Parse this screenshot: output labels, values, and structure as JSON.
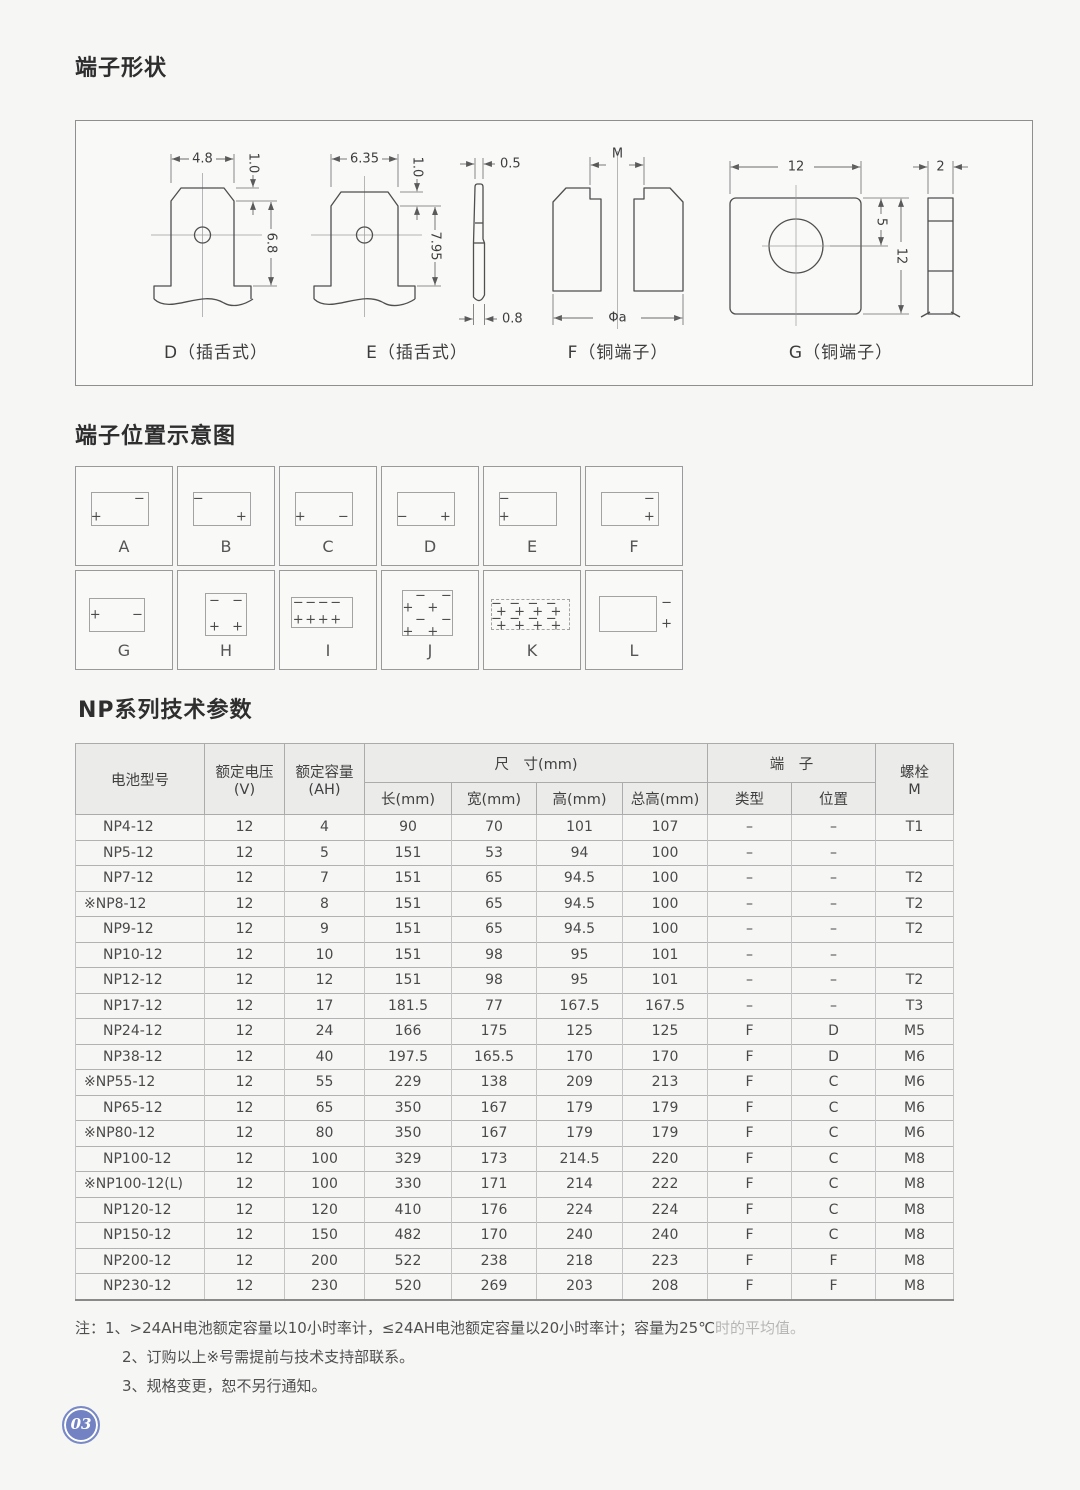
{
  "page": {
    "number": "03"
  },
  "shapes": {
    "title": "端子形状",
    "d_label": "D（插舌式）",
    "d_width": "4.8",
    "d_bevel": "1.0",
    "d_height": "6.8",
    "e_label": "E（插舌式）",
    "e_width": "6.35",
    "e_bevel": "1.0",
    "e_height": "7.95",
    "side_top": "0.5",
    "side_bottom": "0.8",
    "f_label": "F（铜端子）",
    "f_top": "M",
    "f_bottom": "Φa",
    "g_label": "G（铜端子）",
    "g_width": "12",
    "g_hole": "5",
    "g_height": "12",
    "g_thickness": "2"
  },
  "positions": {
    "title": "端子位置示意图",
    "cells": [
      {
        "label": "A",
        "box": [
          16,
          26,
          60,
          34
        ],
        "marks": [
          [
            "−",
            66,
            33
          ],
          [
            "+",
            21,
            51
          ]
        ]
      },
      {
        "label": "B",
        "box": [
          16,
          26,
          60,
          34
        ],
        "marks": [
          [
            "−",
            21,
            33
          ],
          [
            "+",
            66,
            51
          ]
        ]
      },
      {
        "label": "C",
        "box": [
          16,
          26,
          60,
          34
        ],
        "marks": [
          [
            "+",
            21,
            51
          ],
          [
            "−",
            66,
            51
          ]
        ]
      },
      {
        "label": "D",
        "box": [
          16,
          26,
          60,
          34
        ],
        "marks": [
          [
            "−",
            21,
            51
          ],
          [
            "+",
            66,
            51
          ]
        ]
      },
      {
        "label": "E",
        "box": [
          16,
          26,
          60,
          34
        ],
        "marks": [
          [
            "−",
            21,
            33
          ],
          [
            "+",
            21,
            51
          ]
        ]
      },
      {
        "label": "F",
        "box": [
          16,
          26,
          60,
          34
        ],
        "marks": [
          [
            "−",
            66,
            33
          ],
          [
            "+",
            66,
            51
          ]
        ]
      },
      {
        "label": "G",
        "box": [
          14,
          28,
          58,
          34
        ],
        "marks": [
          [
            "+",
            20,
            45
          ],
          [
            "−",
            64,
            45
          ]
        ]
      },
      {
        "label": "H",
        "box": [
          28,
          22,
          44,
          44
        ],
        "marks": [
          [
            "−",
            38,
            31
          ],
          [
            "−",
            62,
            31
          ],
          [
            "+",
            38,
            57
          ],
          [
            "+",
            62,
            57
          ]
        ]
      },
      {
        "label": "I",
        "box": [
          11,
          27,
          65,
          31
        ],
        "marks": [
          [
            "−",
            19,
            33
          ],
          [
            "−",
            32,
            33
          ],
          [
            "−",
            45,
            33
          ],
          [
            "−",
            58,
            33
          ],
          [
            "+",
            19,
            50
          ],
          [
            "+",
            32,
            50
          ],
          [
            "+",
            45,
            50
          ],
          [
            "+",
            58,
            50
          ]
        ]
      },
      {
        "label": "J",
        "box": [
          21,
          19,
          53,
          47
        ],
        "marks": [
          [
            "−",
            40,
            26
          ],
          [
            "−",
            67,
            26
          ],
          [
            "+",
            27,
            38
          ],
          [
            "+",
            53,
            38
          ],
          [
            "−",
            40,
            50
          ],
          [
            "−",
            67,
            50
          ],
          [
            "+",
            27,
            62
          ],
          [
            "+",
            53,
            62
          ]
        ]
      },
      {
        "label": "K",
        "box": [
          7,
          29,
          83,
          31
        ],
        "dashed": true,
        "marks": [
          [
            "−",
            13,
            34
          ],
          [
            "−",
            32,
            34
          ],
          [
            "−",
            51,
            34
          ],
          [
            "−",
            70,
            34
          ],
          [
            "+",
            18,
            42
          ],
          [
            "+",
            37,
            42
          ],
          [
            "+",
            56,
            42
          ],
          [
            "+",
            75,
            42
          ],
          [
            "−",
            13,
            49
          ],
          [
            "−",
            32,
            49
          ],
          [
            "−",
            51,
            49
          ],
          [
            "−",
            70,
            49
          ],
          [
            "+",
            18,
            56
          ],
          [
            "+",
            37,
            56
          ],
          [
            "+",
            56,
            56
          ],
          [
            "+",
            75,
            56
          ]
        ]
      },
      {
        "label": "L",
        "box": [
          14,
          25,
          60,
          37
        ],
        "marks": [
          [
            "−",
            84,
            33
          ],
          [
            "+",
            84,
            54
          ]
        ]
      }
    ]
  },
  "table": {
    "title": "NP系列技术参数",
    "headers": {
      "model": "电池型号",
      "voltage_l1": "额定电压",
      "voltage_l2": "(V)",
      "capacity_l1": "额定容量",
      "capacity_l2": "(AH)",
      "dims": "尺　寸(mm)",
      "len": "长(mm)",
      "width": "宽(mm)",
      "height": "高(mm)",
      "total_height": "总高(mm)",
      "terminal": "端　子",
      "type": "类型",
      "position": "位置",
      "bolt_l1": "螺栓",
      "bolt_l2": "M"
    },
    "rows": [
      [
        "NP4-12",
        "12",
        "4",
        "90",
        "70",
        "101",
        "107",
        "–",
        "–",
        "T1"
      ],
      [
        "NP5-12",
        "12",
        "5",
        "151",
        "53",
        "94",
        "100",
        "–",
        "–",
        ""
      ],
      [
        "NP7-12",
        "12",
        "7",
        "151",
        "65",
        "94.5",
        "100",
        "–",
        "–",
        "T2"
      ],
      [
        "※NP8-12",
        "12",
        "8",
        "151",
        "65",
        "94.5",
        "100",
        "–",
        "–",
        "T2"
      ],
      [
        "NP9-12",
        "12",
        "9",
        "151",
        "65",
        "94.5",
        "100",
        "–",
        "–",
        "T2"
      ],
      [
        "NP10-12",
        "12",
        "10",
        "151",
        "98",
        "95",
        "101",
        "–",
        "–",
        ""
      ],
      [
        "NP12-12",
        "12",
        "12",
        "151",
        "98",
        "95",
        "101",
        "–",
        "–",
        "T2"
      ],
      [
        "NP17-12",
        "12",
        "17",
        "181.5",
        "77",
        "167.5",
        "167.5",
        "–",
        "–",
        "T3"
      ],
      [
        "NP24-12",
        "12",
        "24",
        "166",
        "175",
        "125",
        "125",
        "F",
        "D",
        "M5"
      ],
      [
        "NP38-12",
        "12",
        "40",
        "197.5",
        "165.5",
        "170",
        "170",
        "F",
        "D",
        "M6"
      ],
      [
        "※NP55-12",
        "12",
        "55",
        "229",
        "138",
        "209",
        "213",
        "F",
        "C",
        "M6"
      ],
      [
        "NP65-12",
        "12",
        "65",
        "350",
        "167",
        "179",
        "179",
        "F",
        "C",
        "M6"
      ],
      [
        "※NP80-12",
        "12",
        "80",
        "350",
        "167",
        "179",
        "179",
        "F",
        "C",
        "M6"
      ],
      [
        "NP100-12",
        "12",
        "100",
        "329",
        "173",
        "214.5",
        "220",
        "F",
        "C",
        "M8"
      ],
      [
        "※NP100-12(L)",
        "12",
        "100",
        "330",
        "171",
        "214",
        "222",
        "F",
        "C",
        "M8"
      ],
      [
        "NP120-12",
        "12",
        "120",
        "410",
        "176",
        "224",
        "224",
        "F",
        "C",
        "M8"
      ],
      [
        "NP150-12",
        "12",
        "150",
        "482",
        "170",
        "240",
        "240",
        "F",
        "C",
        "M8"
      ],
      [
        "NP200-12",
        "12",
        "200",
        "522",
        "238",
        "218",
        "223",
        "F",
        "F",
        "M8"
      ],
      [
        "NP230-12",
        "12",
        "230",
        "520",
        "269",
        "203",
        "208",
        "F",
        "F",
        "M8"
      ]
    ]
  },
  "notes": {
    "line1": "注：1、>24AH电池额定容量以10小时率计，≤24AH电池额定容量以20小时率计；容量为25℃",
    "line1_faded": "时的平均值。",
    "line2": "2、订购以上※号需提前与技术支持部联系。",
    "line3": "3、规格变更，恕不另行通知。"
  }
}
